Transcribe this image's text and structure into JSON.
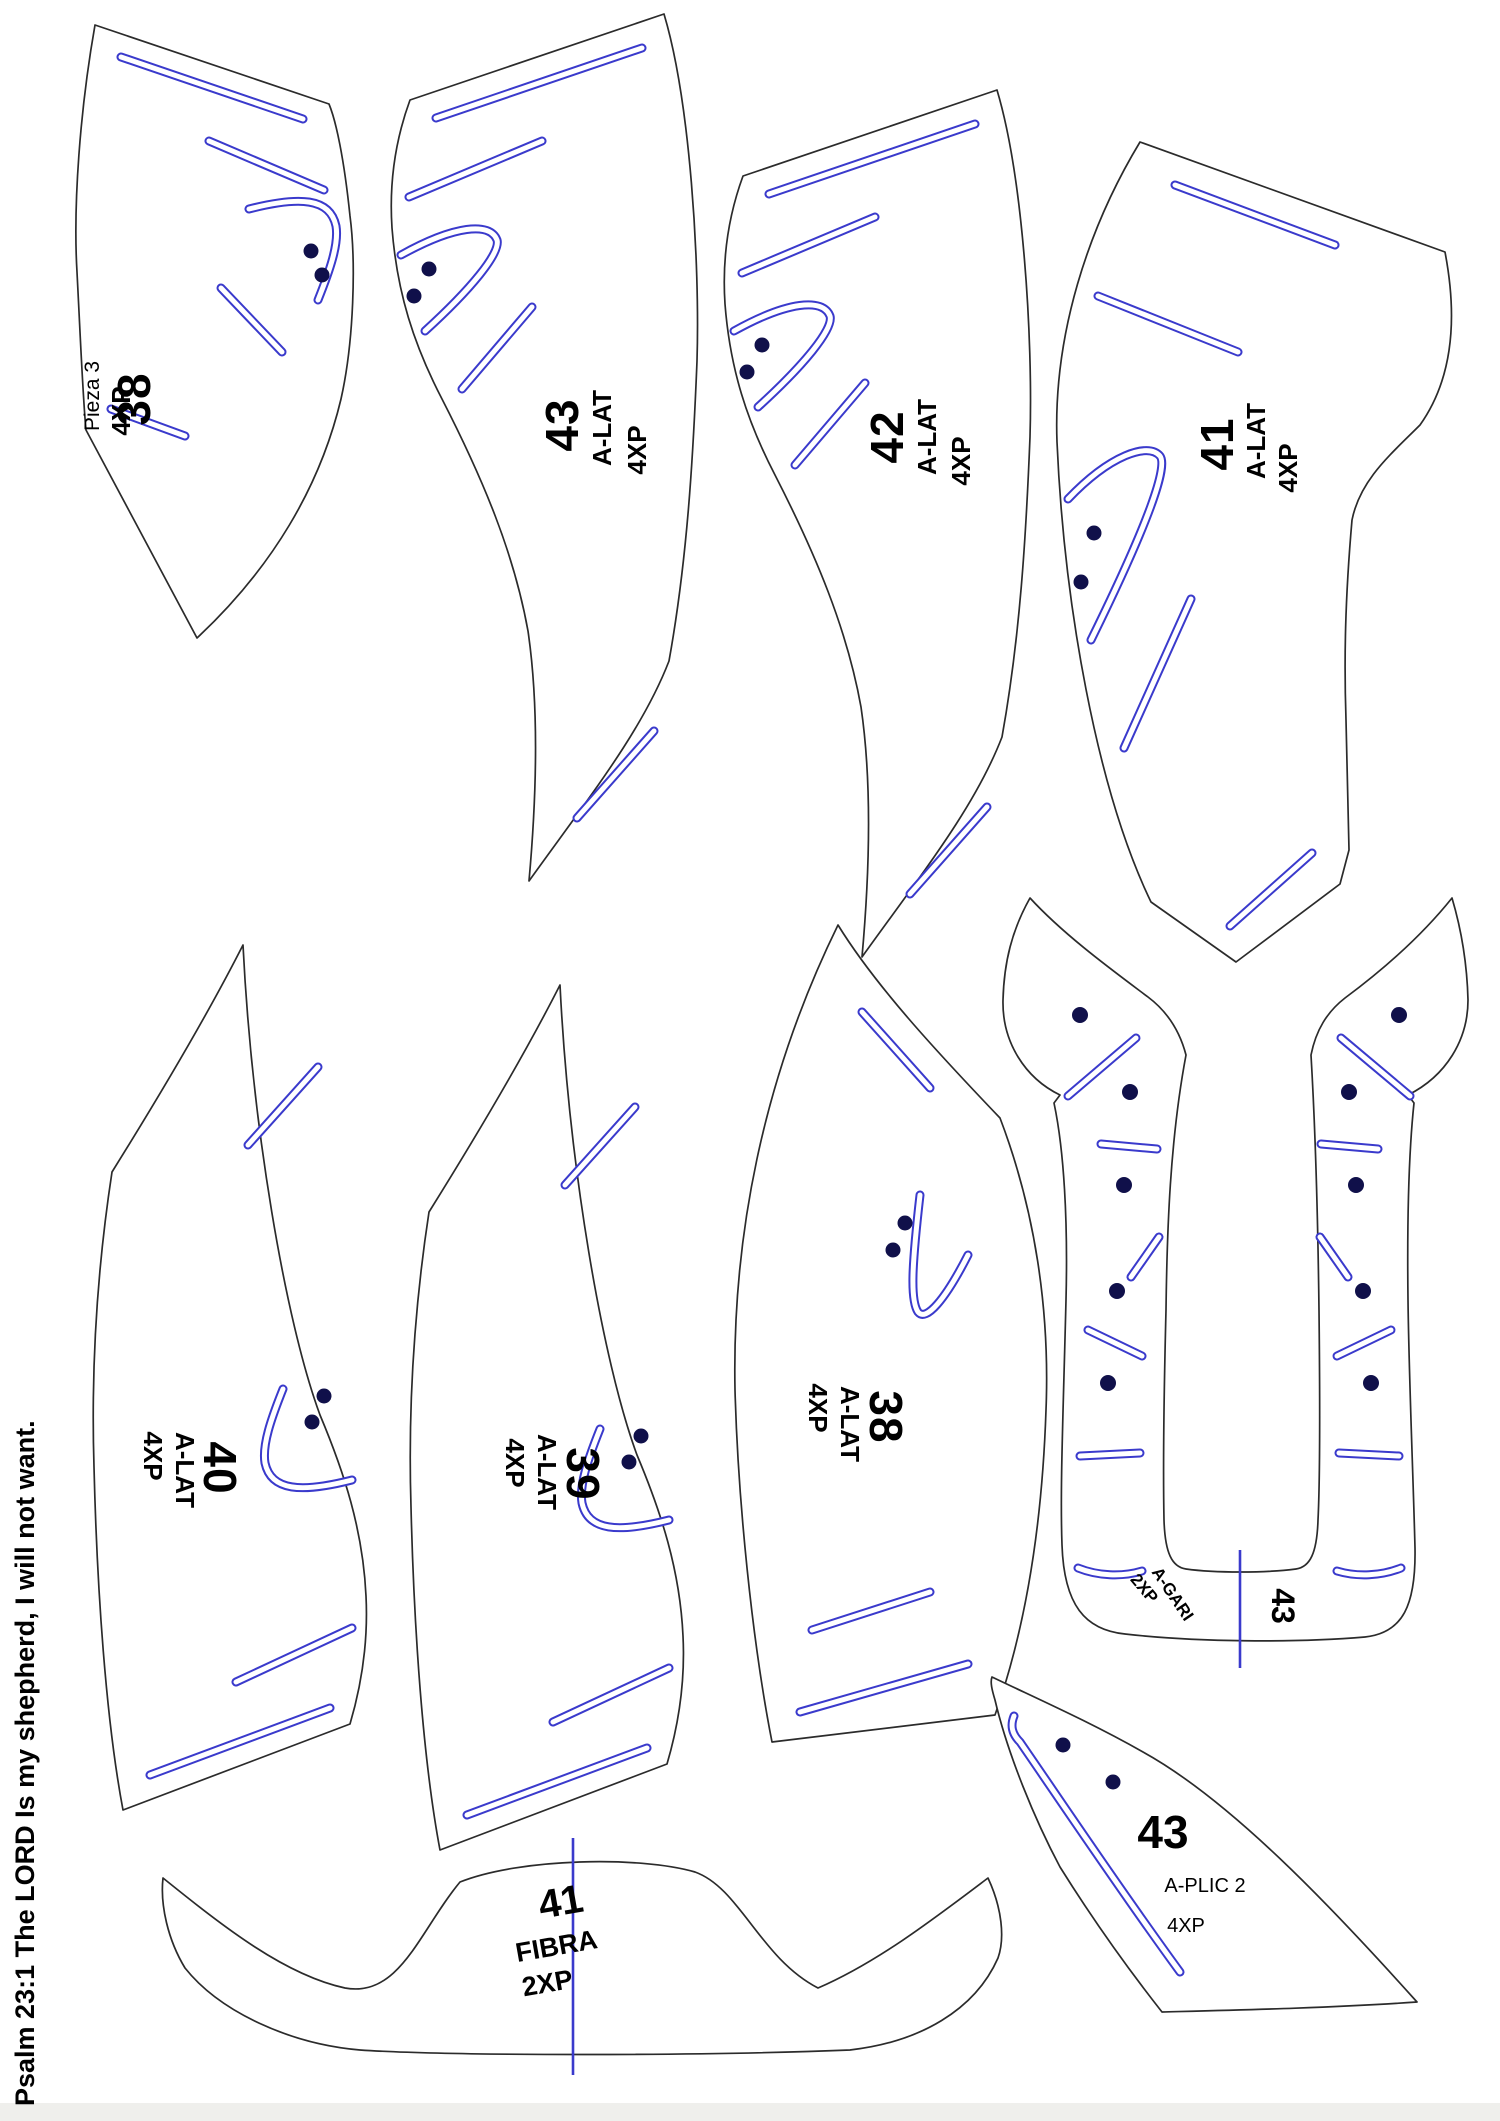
{
  "page": {
    "footer_verse": "Psalm 23:1 The LORD Is my shepherd, I will not want."
  },
  "colors": {
    "background": "#ffffff",
    "outline": "#2b2b2b",
    "slot_blue": "#3a3acc",
    "dot_navy": "#10104a"
  },
  "pieces": {
    "pieza3": {
      "name": "Pieza 3",
      "qty": "4XP",
      "size": "38"
    },
    "alat43": {
      "size": "43",
      "type": "A-LAT",
      "qty": "4XP"
    },
    "alat42": {
      "size": "42",
      "type": "A-LAT",
      "qty": "4XP"
    },
    "alat41": {
      "size": "41",
      "type": "A-LAT",
      "qty": "4XP"
    },
    "alat40": {
      "size": "40",
      "type": "A-LAT",
      "qty": "4XP"
    },
    "alat39": {
      "size": "39",
      "type": "A-LAT",
      "qty": "4XP"
    },
    "alat38": {
      "size": "38",
      "type": "A-LAT",
      "qty": "4XP"
    },
    "agari": {
      "name": "A-GARI",
      "qty": "2XP",
      "size": "43"
    },
    "fibra": {
      "size": "41",
      "name": "FIBRA",
      "qty": "2XP"
    },
    "aplic": {
      "size": "43",
      "name": "A-PLIC 2",
      "qty": "4XP"
    }
  }
}
